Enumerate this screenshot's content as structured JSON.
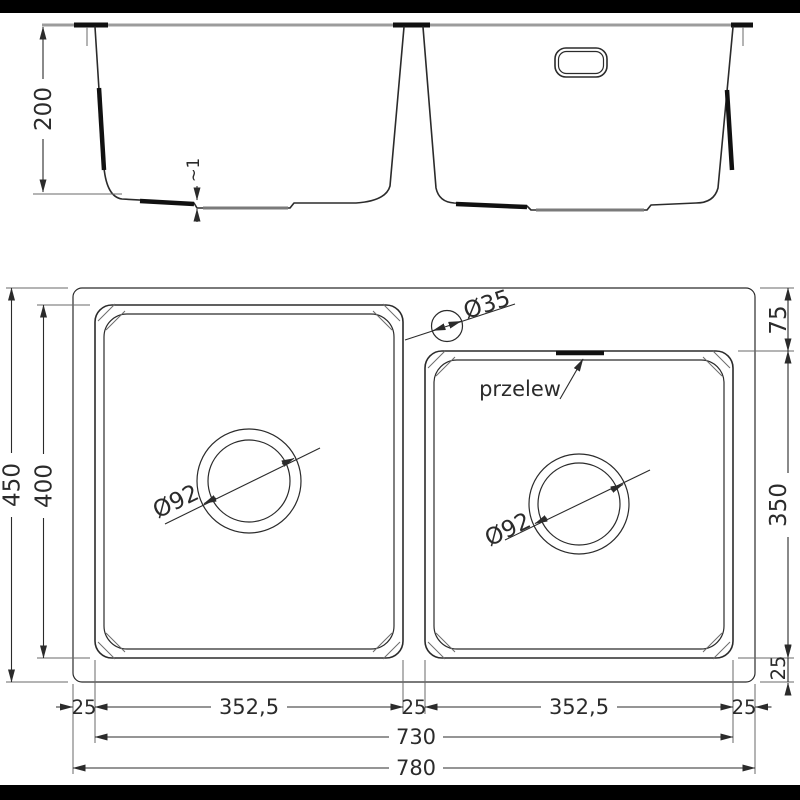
{
  "colors": {
    "background": "#ffffff",
    "bar": "#000000",
    "line": "#2b2b2b",
    "thin_line": "#6a6a6a",
    "countertop_line": "#9c9c9c",
    "accent": "#111111"
  },
  "elevation_view": {
    "depth_dim": "200",
    "bottom_step_dim": "~1"
  },
  "plan_view": {
    "overall_depth_dim": "450",
    "left_bowl_depth_dim": "400",
    "right_top_offset_dim": "75",
    "right_bowl_depth_dim": "350",
    "right_bottom_offset_dim": "25",
    "faucet_hole_dim": "Ø35",
    "overflow_label": "przelew",
    "left_drain_dim": "Ø92",
    "right_drain_dim": "Ø92",
    "bottom_row1": [
      "25",
      "352,5",
      "25",
      "352,5",
      "25"
    ],
    "bowls_span_dim": "730",
    "overall_width_dim": "780"
  }
}
